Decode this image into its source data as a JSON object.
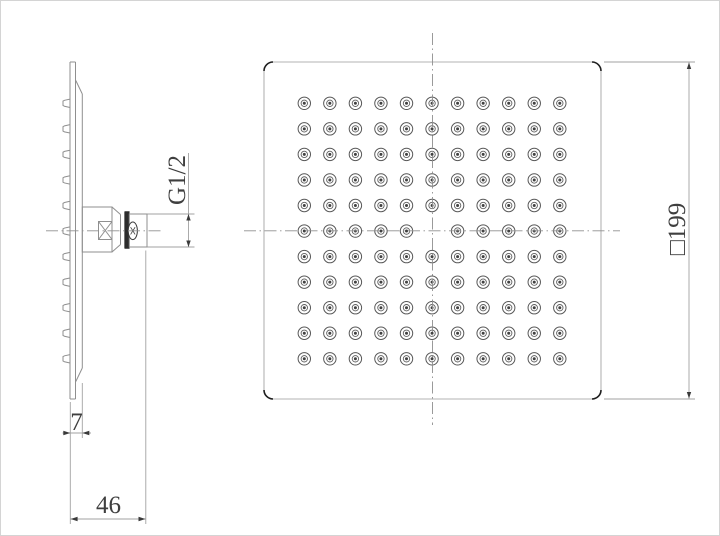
{
  "drawing": {
    "type": "technical-drawing",
    "subject": "square rain shower head, two orthographic views",
    "colors": {
      "background": "#ffffff",
      "geometry_line": "#8f8f8f",
      "square_outline": "#b3b3b3",
      "corner_accent": "#1f1f1f",
      "dimension_line": "#a2a2a2",
      "text": "#3f3f3f",
      "nut_fill": "#2c2c2c",
      "nozzle_ring": "#575757",
      "nozzle_dot": "#414141"
    },
    "dimensions": {
      "thread": {
        "label": "G1/2"
      },
      "plate_thickness": {
        "label": "7"
      },
      "depth": {
        "label": "46"
      },
      "face_size": {
        "label": "□199"
      }
    },
    "front_view": {
      "nozzle_grid": {
        "rows": 11,
        "cols": 11,
        "center_omitted": true,
        "origin_x": 303.3,
        "origin_y": 102.3,
        "spacing": 25.55,
        "outer_r": 6.2,
        "inner_r": 3.2,
        "dot_r": 1.5
      }
    },
    "side_view": {
      "nozzles": {
        "count": 11,
        "first_y": 102.3,
        "spacing": 25.55,
        "base_x": 69,
        "tip_x": 62
      }
    }
  }
}
